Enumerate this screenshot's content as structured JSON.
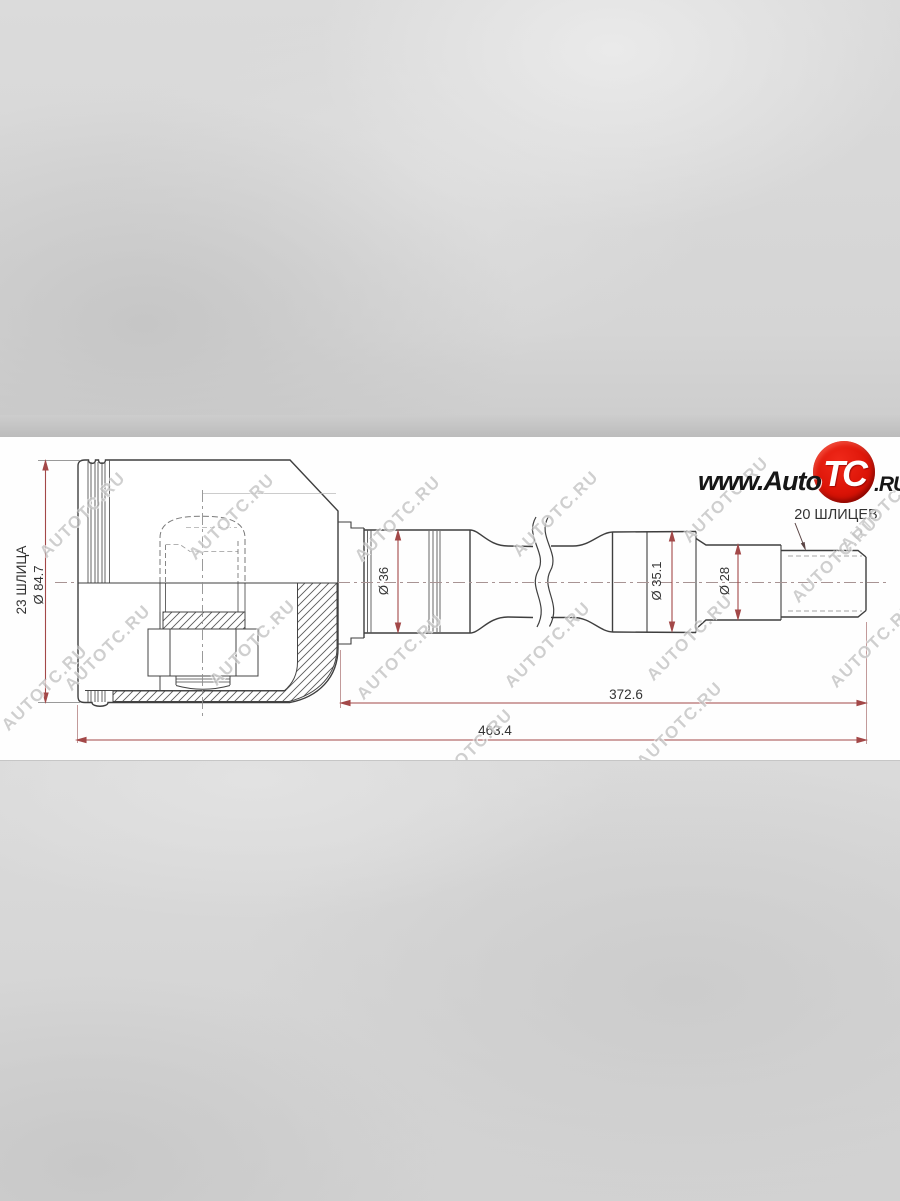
{
  "watermark": {
    "text": "AUTOTC.RU"
  },
  "logo": {
    "www": "www.Auto",
    "tc": "TC",
    "ru": ".RU"
  },
  "labels": {
    "splines_left": "23 ШЛИЦА",
    "dia_housing": "Ø 84.7",
    "dia_36": "Ø 36",
    "dia_35_1": "Ø 35.1",
    "dia_28": "Ø 28",
    "splines_right": "20 ШЛИЦЕВ",
    "length_inner": "372.6",
    "length_total": "463.4"
  },
  "colors": {
    "dimension_red": "#a34848",
    "extension_pale": "#bb9090",
    "outline": "#3f3f3f",
    "hidden_gray": "#7a7a7a",
    "logo_red": "#dc1407",
    "watermark_gray": "#808080",
    "paper": "#fefefe",
    "background_gray": "#d6d6d6"
  }
}
